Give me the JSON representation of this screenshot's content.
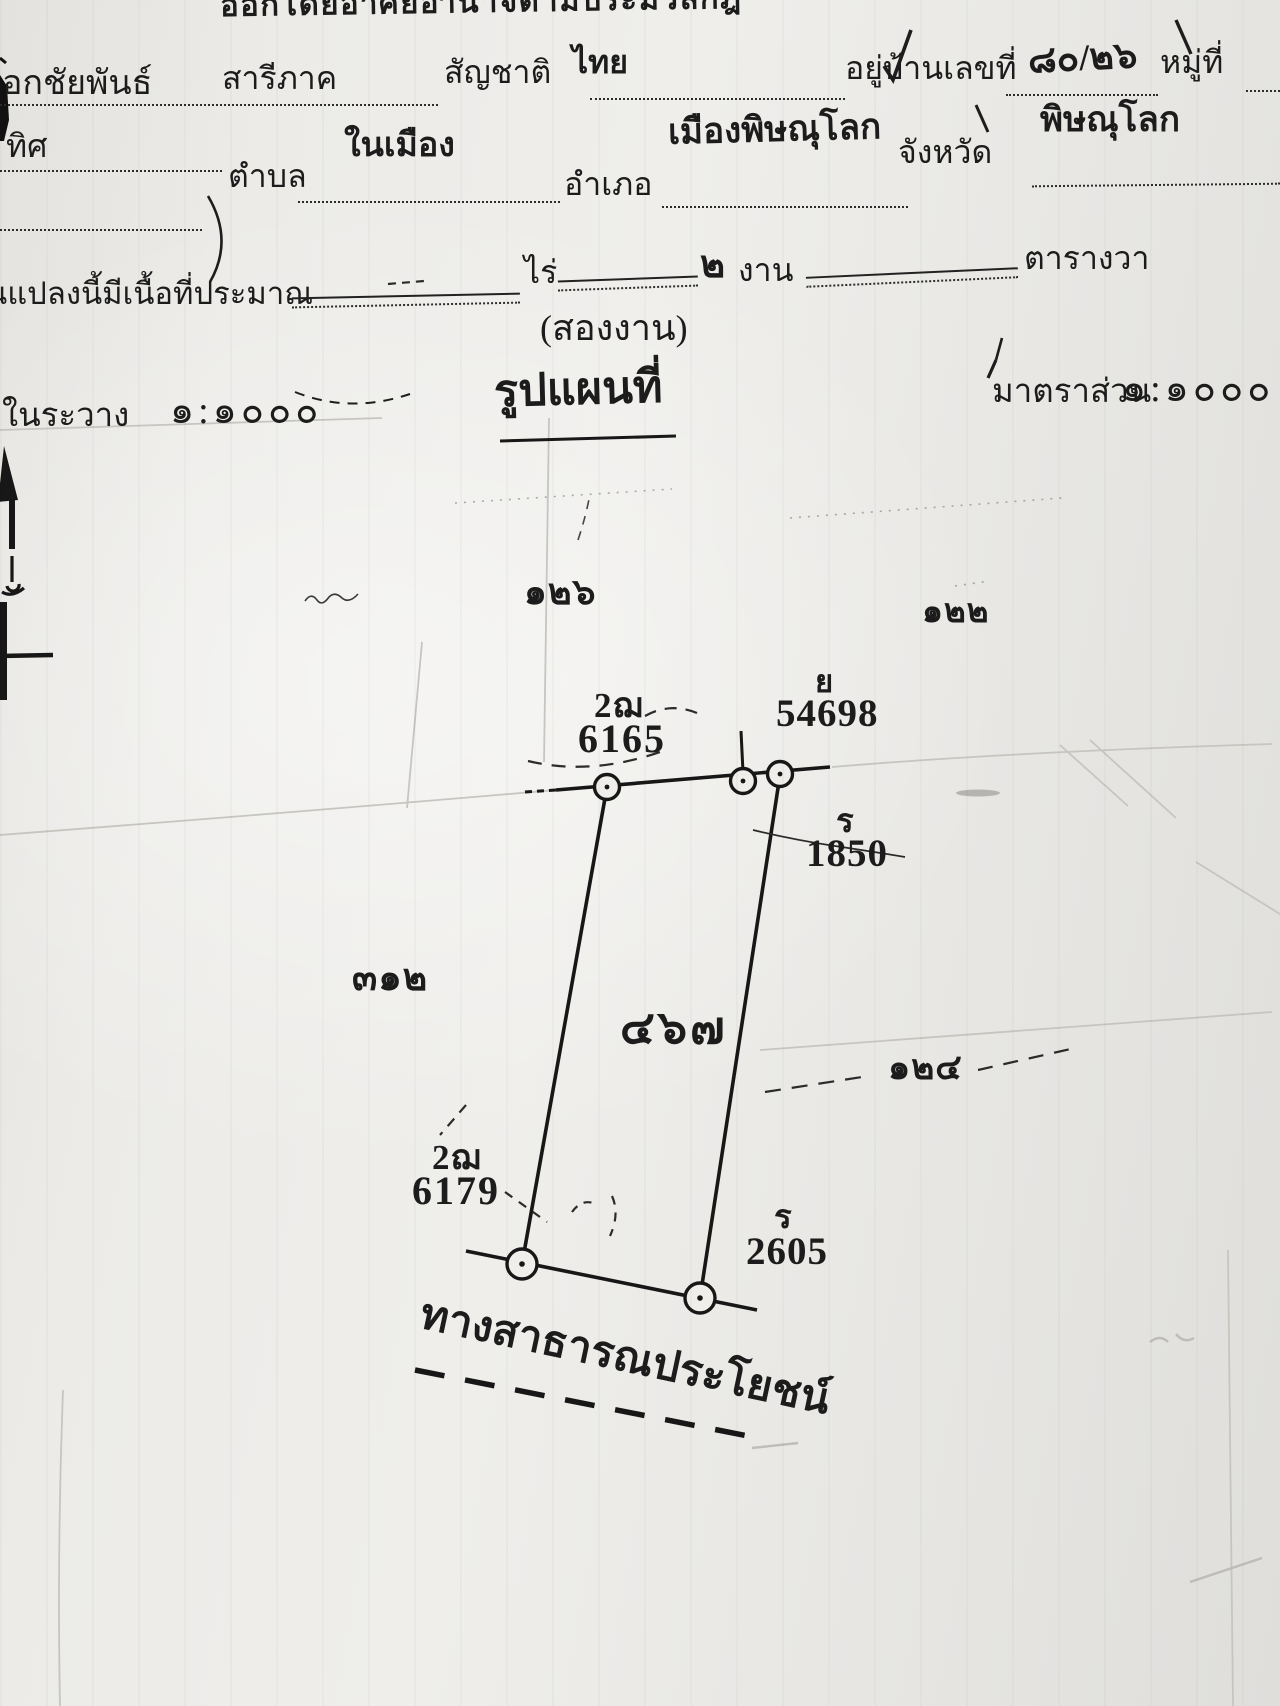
{
  "document": {
    "authority_line": "ออกโดยอาศัยอำนาจตามประมวลกฎ",
    "owner": {
      "name_partial": "อกชัยพันธ์",
      "surname": "สารีภาค",
      "nationality_label": "สัญชาติ",
      "nationality_value": "ไทย",
      "address_label": "อยู่บ้านเลขที่",
      "address_value": "๘๐/๒๖",
      "moo_label": "หมู่ที่"
    },
    "location": {
      "direction_label": "ทิศ",
      "tambon_label": "ตำบล",
      "tambon_value": "ในเมือง",
      "amphoe_label": "อำเภอ",
      "amphoe_value": "เมืองพิษณุโลก",
      "province_label": "จังหวัด",
      "province_value": "พิษณุโลก"
    },
    "area": {
      "label_partial": "นแปลงนี้มีเนื้อที่ประมาณ",
      "rai_label": "ไร่",
      "ngan_value": "๒",
      "ngan_label": "งาน",
      "wa_label": "ตารางวา",
      "area_in_words": "(สองงาน)"
    },
    "map_header": {
      "rawang_label": "ในระวาง",
      "rawang_scale": "๑:๑๐๐๐",
      "map_title": "รูปแผนที่",
      "scale_label": "มาตราส่วน",
      "scale_value": "๑:๑๐๐๐"
    }
  },
  "map": {
    "adjacent_plots": {
      "north": "๑๒๖",
      "northeast": "๑๒๒",
      "west": "๓๑๒",
      "east": "๑๒๔"
    },
    "parcel_number": "๔๖๗",
    "codes": {
      "top_code": "2ฌ",
      "top_number": "6165",
      "sw_code": "2ฌ",
      "sw_number": "6179"
    },
    "markers": {
      "y_label": "ย",
      "y_number": "54698",
      "r1_label": "ร",
      "r1_number": "1850",
      "r2_label": "ร",
      "r2_number": "2605"
    },
    "road_label": "ทางสาธารณประโยชน์"
  }
}
